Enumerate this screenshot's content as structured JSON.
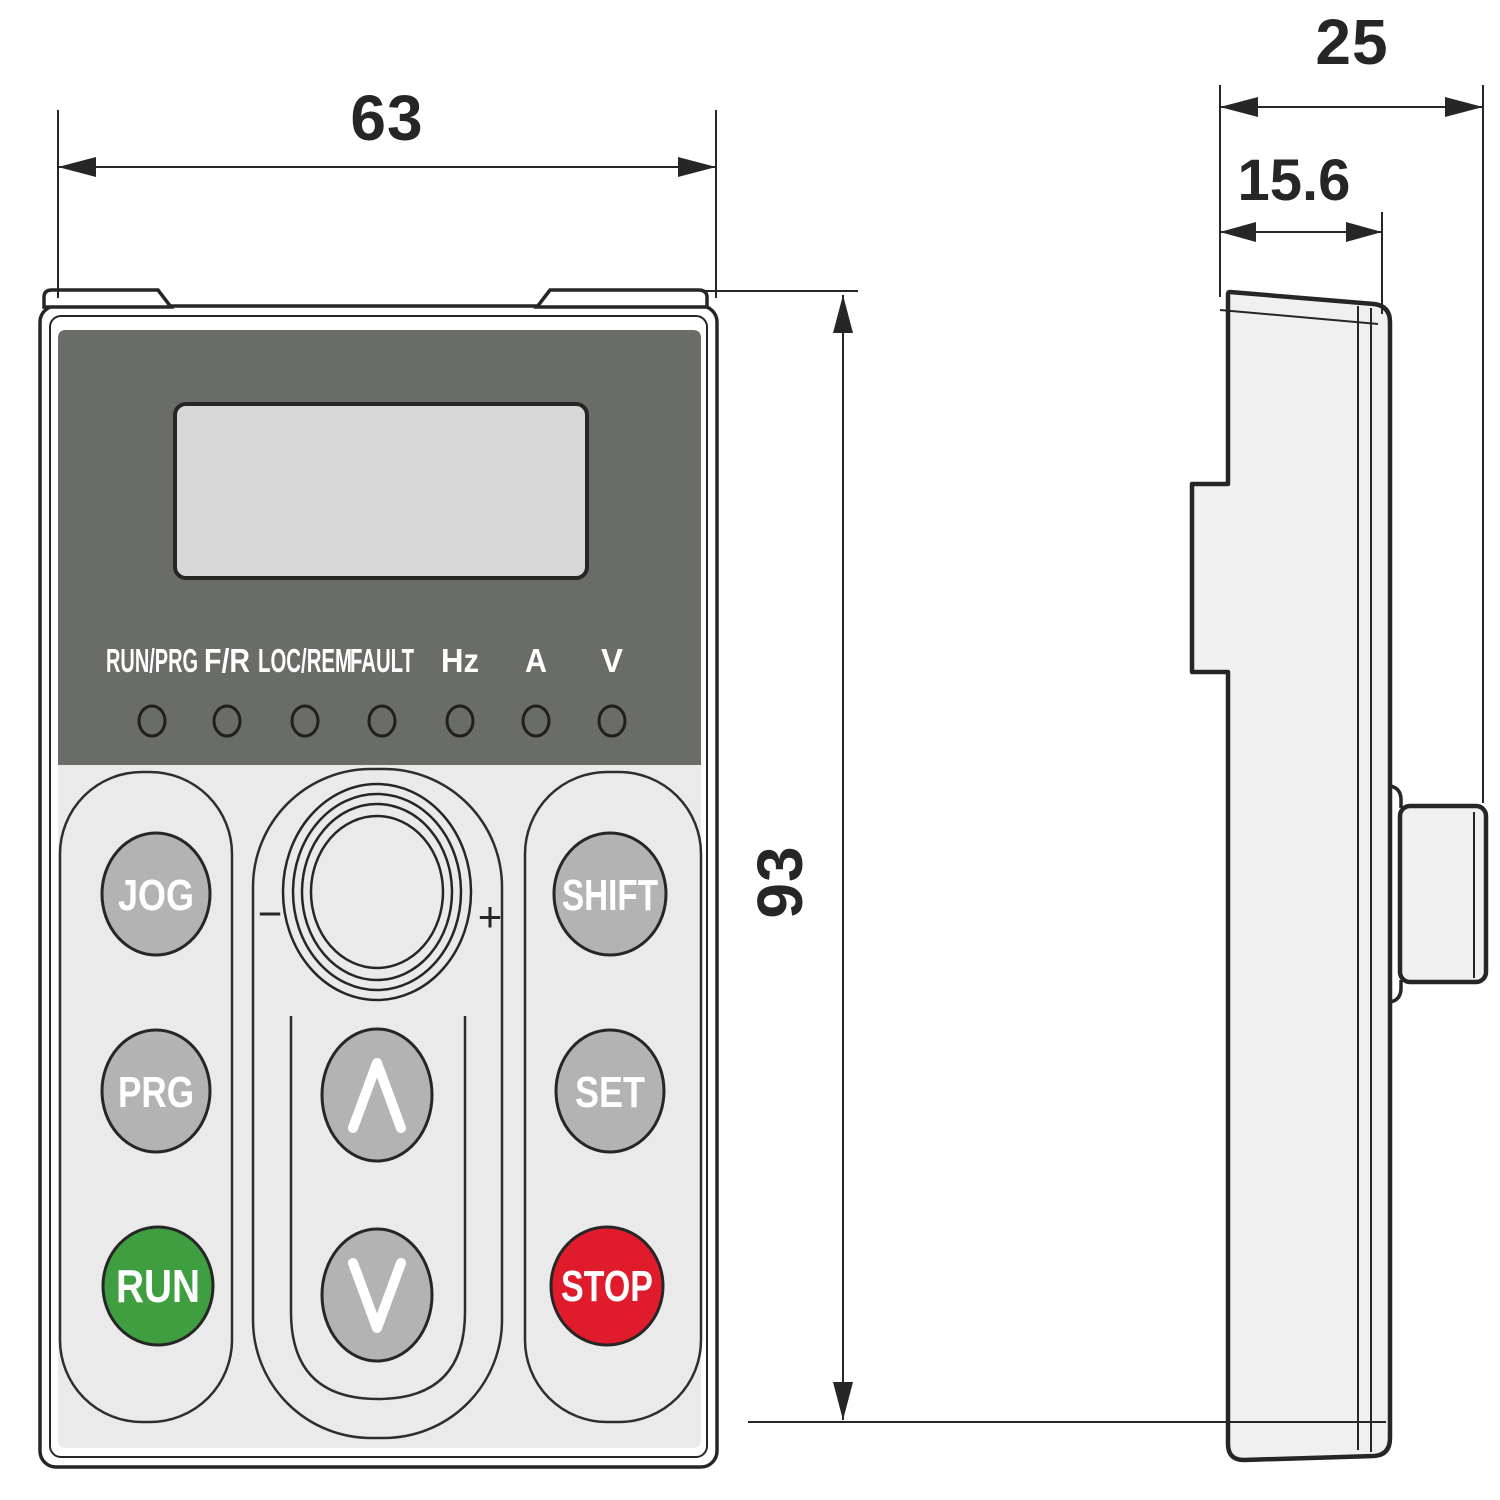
{
  "drawing": {
    "title": "keypad-dimension-drawing",
    "dimensions": {
      "front_width_mm": "63",
      "front_height_mm": "93",
      "side_depth_total_mm": "25",
      "side_depth_body_mm": "15.6"
    },
    "front_view": {
      "indicator_labels": [
        "RUN/PRG",
        "F/R",
        "LOC/REM",
        "FAULT",
        "Hz",
        "A",
        "V"
      ],
      "buttons": {
        "jog": "JOG",
        "prg": "PRG",
        "run": "RUN",
        "shift": "SHIFT",
        "set": "SET",
        "stop": "STOP"
      },
      "knob": {
        "minus": "−",
        "plus": "+"
      }
    },
    "colors": {
      "outline": "#262626",
      "panel_dark": "#696c67",
      "display_screen": "#d7d7d7",
      "keypad_bg": "#eaeaea",
      "button_gray": "#b3b3b3",
      "run_green": "#3f9e3f",
      "stop_red": "#e01b2c",
      "side_fill": "#f0f0f0"
    }
  }
}
